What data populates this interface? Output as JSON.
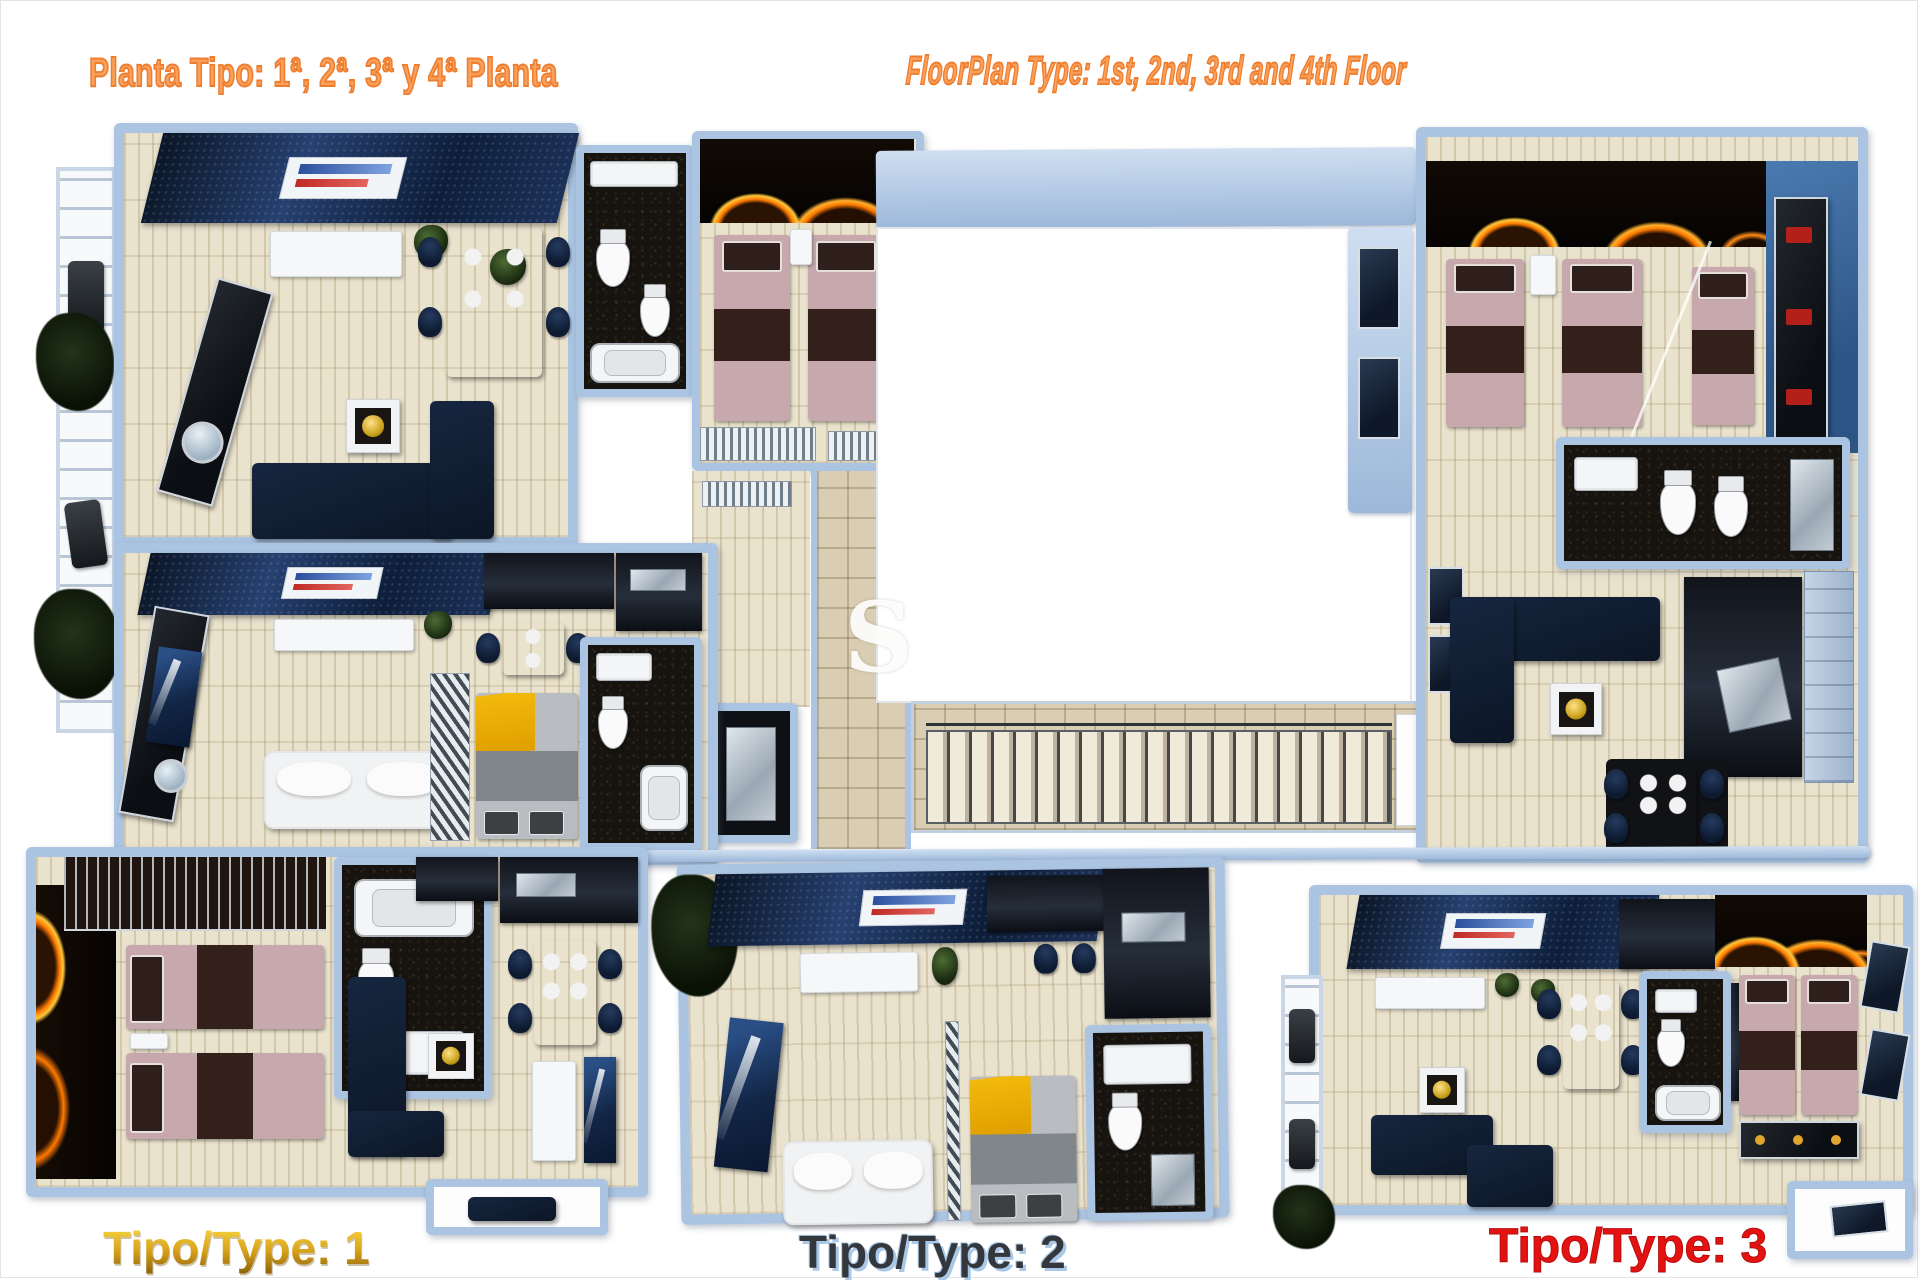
{
  "header": {
    "title_left": "Planta Tipo: 1ª, 2ª, 3ª y 4ª Planta",
    "title_right": "FloorPlan Type: 1st, 2nd, 3rd and 4th Floor"
  },
  "plan_labels": {
    "type1": "Tipo/Type: 1",
    "type2": "Tipo/Type: 2",
    "type3": "Tipo/Type: 3"
  },
  "watermark": "S",
  "palette": {
    "accent_orange": "#ef7d2e",
    "accent_orange_light": "#f9a15c",
    "label_gold": "#d8a21b",
    "label_gold_dark": "#8a5f08",
    "label_ink": "#34373c",
    "label_ink_shadow": "#a9c7e6",
    "label_red": "#e41312",
    "wall_blue": "#aac4e2",
    "wall_blue_deep": "#7e9cc4",
    "floor_beige": "#e9e2cd",
    "floor_beige_deep": "#d9ceb3",
    "navy": "#16263f",
    "navy_deep": "#0c1626",
    "black_tile": "#17130e",
    "fire_orange": "#ff7a00",
    "fire_gold": "#ffc83d",
    "bed_pink": "#c7a9ad",
    "bed_brown": "#33201b",
    "bed_yellow": "#f2b90c",
    "bed_gray": "#81868b",
    "white_furniture": "#f6f7f8",
    "steel": "#b9c3cc"
  }
}
